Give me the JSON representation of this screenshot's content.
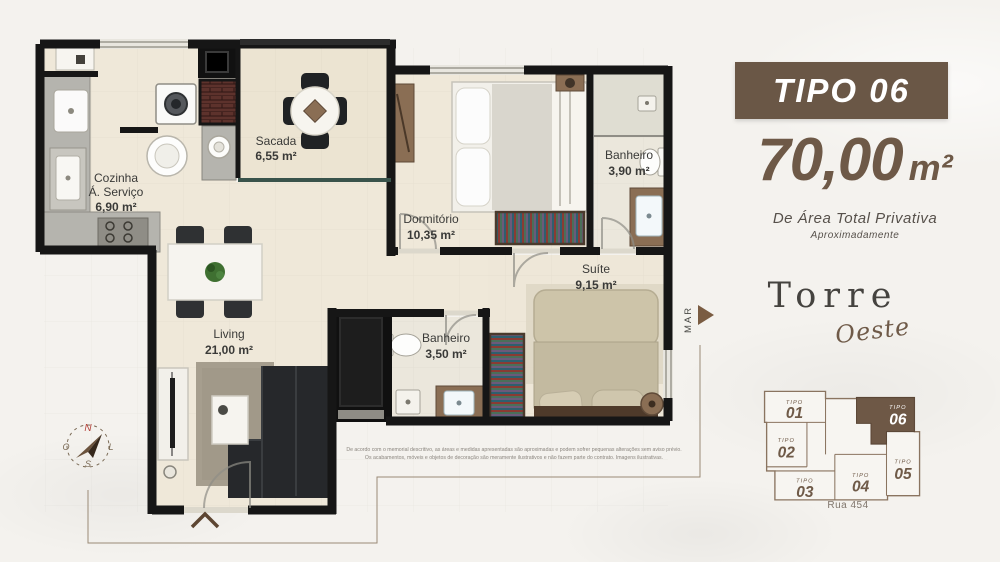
{
  "panel": {
    "type_label": "TIPO 06",
    "area_value": "70,00",
    "area_unit": "m²",
    "area_caption": "De Área Total Privativa",
    "area_note": "Aproximadamente",
    "tower_line1": "Torre",
    "tower_line2": "Oeste",
    "street_label": "Rua 454"
  },
  "plan": {
    "rooms": [
      {
        "key": "cozinha",
        "line1": "Cozinha",
        "line2": "Á. Serviço",
        "area": "6,90 m²"
      },
      {
        "key": "sacada",
        "line1": "Sacada",
        "area": "6,55 m²"
      },
      {
        "key": "dormitorio",
        "line1": "Dormitório",
        "area": "10,35 m²"
      },
      {
        "key": "banheiro-1",
        "line1": "Banheiro",
        "area": "3,90 m²"
      },
      {
        "key": "suite",
        "line1": "Suíte",
        "area": "9,15 m²"
      },
      {
        "key": "banheiro-2",
        "line1": "Banheiro",
        "area": "3,50 m²"
      },
      {
        "key": "living",
        "line1": "Living",
        "area": "21,00 m²"
      }
    ],
    "sea_label": "MAR",
    "compass": {
      "north": "N",
      "east": "L",
      "south": "S",
      "west": "O"
    },
    "disclaimer_line1": "De acordo com o memorial descritivo, as áreas e medidas apresentadas são aproximadas e podem sofrer pequenas alterações sem aviso prévio.",
    "disclaimer_line2": "Os acabamentos, móveis e objetos de decoração são meramente ilustrativos e não fazem parte do contrato. Imagens ilustrativas."
  },
  "keyplan": {
    "unit_prefix": "TIPO",
    "units": [
      {
        "number": "01"
      },
      {
        "number": "02"
      },
      {
        "number": "03"
      },
      {
        "number": "04"
      },
      {
        "number": "05"
      },
      {
        "number": "06",
        "highlighted": true
      }
    ]
  },
  "colors": {
    "brand_brown": "#6a5746",
    "text_brown": "#6e5947",
    "wall_black": "#161616",
    "floor_beige": "#efe8d9",
    "highlight_unit": "#6e5846"
  }
}
